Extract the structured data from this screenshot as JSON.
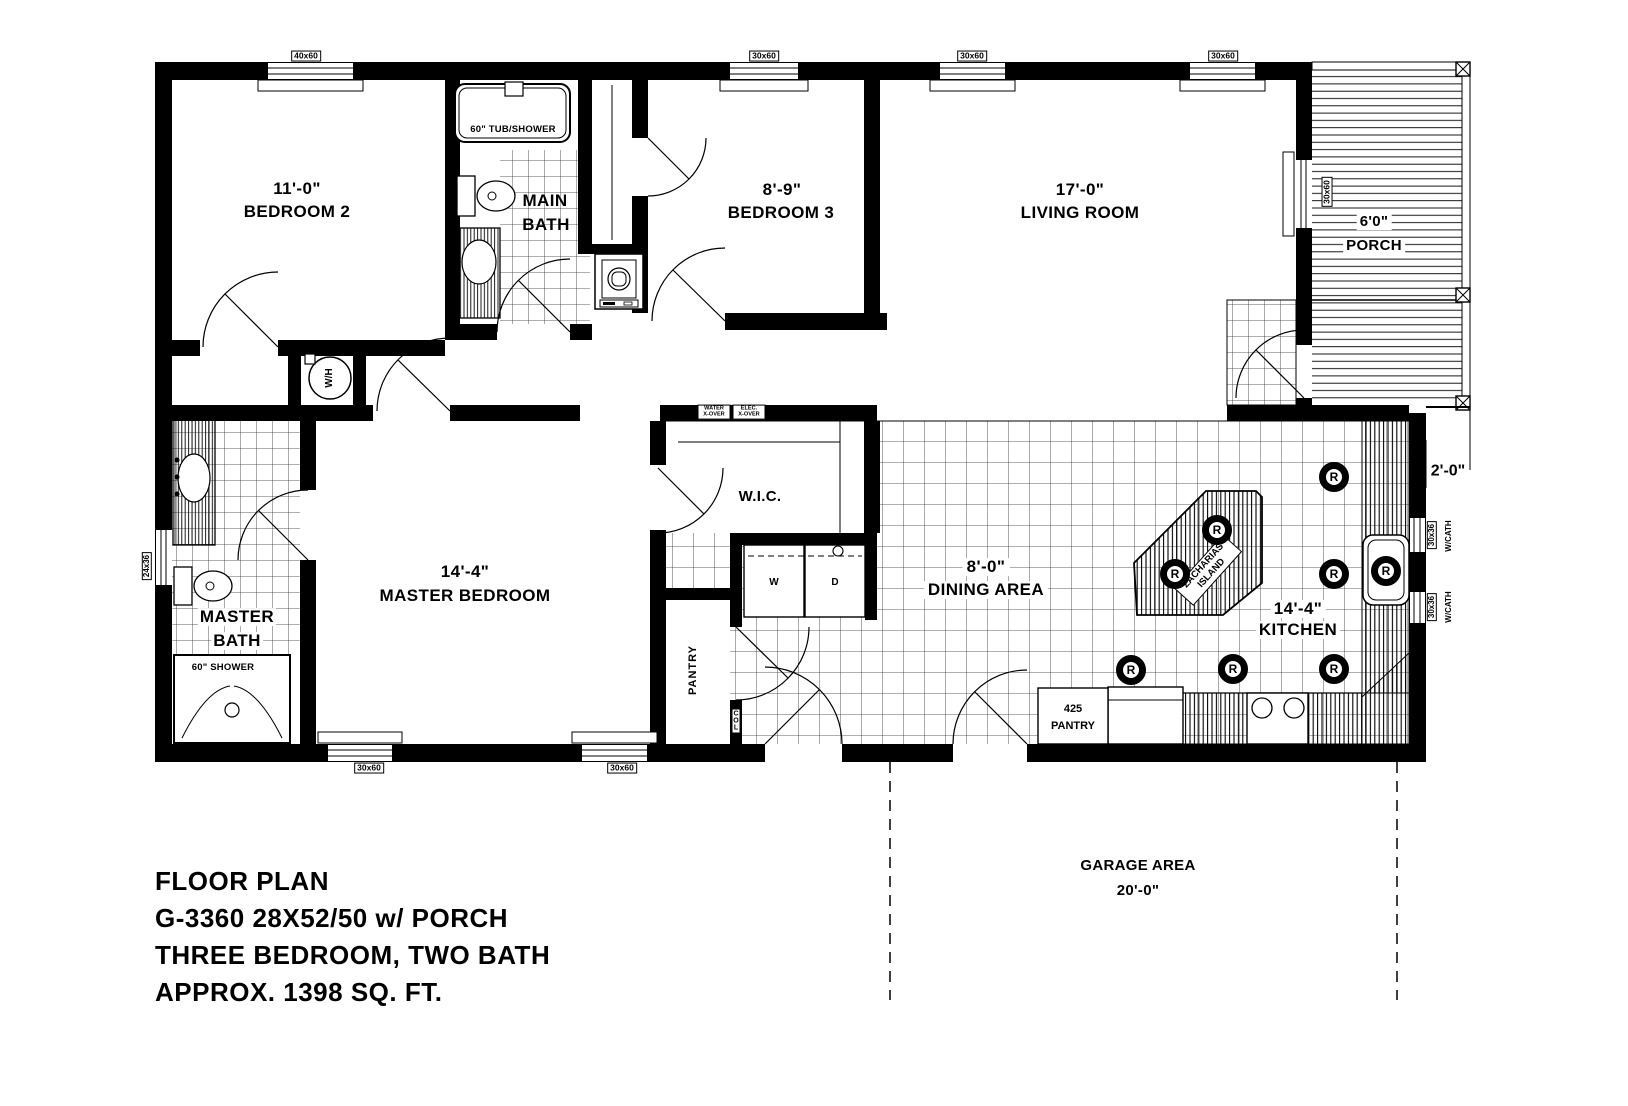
{
  "title_block": {
    "line1": "FLOOR PLAN",
    "line2": "G-3360 28X52/50 w/ PORCH",
    "line3": "THREE BEDROOM, TWO BATH",
    "line4": "APPROX. 1398 SQ. FT."
  },
  "rooms": {
    "bedroom2": {
      "dim": "11'-0\"",
      "name": "BEDROOM 2"
    },
    "bedroom3": {
      "dim": "8'-9\"",
      "name": "BEDROOM 3"
    },
    "living_room": {
      "dim": "17'-0\"",
      "name": "LIVING ROOM"
    },
    "porch": {
      "dim": "6'0\"",
      "name": "PORCH"
    },
    "main_bath": {
      "line1": "MAIN",
      "line2": "BATH"
    },
    "master_bath": {
      "line1": "MASTER",
      "line2": "BATH"
    },
    "master_bedroom": {
      "dim": "14'-4\"",
      "name": "MASTER BEDROOM"
    },
    "wic": {
      "name": "W.I.C."
    },
    "dining": {
      "dim": "8'-0\"",
      "name": "DINING AREA"
    },
    "kitchen": {
      "dim": "14'-4\"",
      "name": "KITCHEN"
    },
    "pantry": {
      "name": "PANTRY"
    },
    "corner_pantry": {
      "line1": "425",
      "line2": "PANTRY"
    },
    "garage": {
      "name": "GARAGE AREA",
      "dim": "20'-0\""
    }
  },
  "fixtures": {
    "tub": "60\" TUB/SHOWER",
    "shower": "60\" SHOWER",
    "water_heater": "W/H",
    "washer": "W",
    "dryer": "D",
    "island_line1": "\"ZACHARIAS\"",
    "island_line2": "ISLAND",
    "column": "COL"
  },
  "windows": {
    "w40x60": "40x60",
    "w30x60": "30x60",
    "w24x36": "24x36",
    "w30x36": "30x36",
    "cathedral": "W/CATH"
  },
  "annotations": {
    "eave": "2'-0\"",
    "water_xover_1": "WATER",
    "water_xover_2": "X-OVER",
    "elec_xover_1": "ELEC.",
    "elec_xover_2": "X-OVER",
    "recessed_light": "R"
  }
}
